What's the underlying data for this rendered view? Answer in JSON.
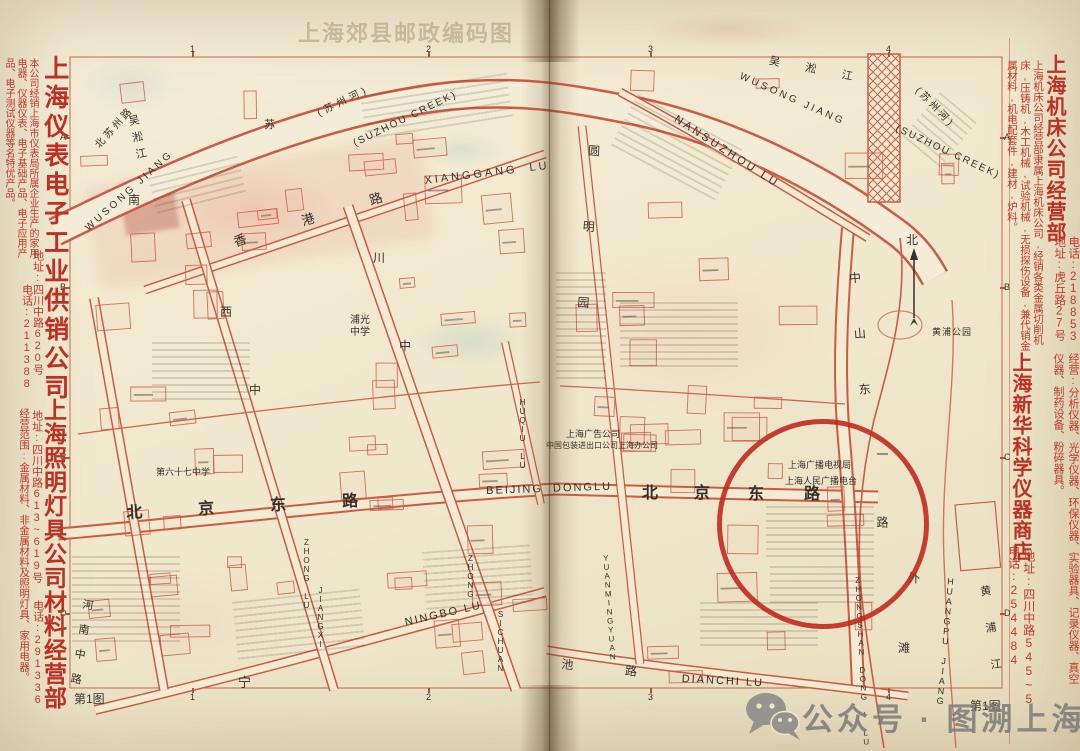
{
  "page": {
    "bleed_title": "上海郊县邮政编码图",
    "sheet_label": "第1图",
    "watermark_text": "公众号 · 图溯上海",
    "watermark_icon": "wechat-icon"
  },
  "colors": {
    "paper": "#f1e9d0",
    "map_red": "#cd5a44",
    "ad_red": "#c0392b",
    "ink": "#35302a",
    "circle_red": "#c0251a",
    "watermark_gray": "#7a7a7a"
  },
  "ads": {
    "left_top": {
      "title": "上海仪表电子工业供销公司",
      "body": "本公司经销上海市仪表局所属企业生产的家用电器、仪器仪表、电子基础产品、电子应用产品、电子测试仪器等名特优产品。",
      "address": "地址:四川中路620号",
      "phone": "电话:211388"
    },
    "left_bottom": {
      "title": "上海照明灯具公司材料经营部",
      "body": "经营范围:金属材料、非金属材料及照明灯具、家用电器。",
      "address": "地址:四川中路613~619号",
      "phone": "电话:291336"
    },
    "right_top": {
      "title": "上海机床公司经营部",
      "body": "上海机床公司经营部隶属上海机床公司,经销各类金属切削机床,压铸机,木工机械,试验机械,无损探伤设备,兼代销金属材料,机电配套件,建材,炉料。",
      "address": "地址:虎丘路27号",
      "phone": "电话:218853"
    },
    "right_bottom": {
      "title": "上海新华科学仪器商店",
      "body": "经营:分析仪器、光学仪器、环保仪器、实验器具、记录仪器、真空仪器、制药设备、粉碎器具。",
      "address": "地址:四川中路545~5",
      "phone": "电话:254484"
    }
  },
  "grid": {
    "columns": [
      "1",
      "2",
      "3",
      "4"
    ],
    "rows": [
      "A",
      "B",
      "C",
      "D"
    ]
  },
  "map_labels": [
    {
      "t": "WUSONG JIANG",
      "x": 84,
      "y": 226,
      "fs": 10,
      "ls": 3,
      "rot": -42
    },
    {
      "t": "(苏州河)",
      "x": 316,
      "y": 110,
      "fs": 10,
      "ls": 4,
      "rot": -26
    },
    {
      "t": "(SUZHOU CREEK)",
      "x": 352,
      "y": 140,
      "fs": 10,
      "ls": 2,
      "rot": -26
    },
    {
      "t": "北苏州路",
      "x": 94,
      "y": 144,
      "fs": 10,
      "ls": 3,
      "rot": -48
    },
    {
      "t": "吴淞江",
      "x": 126,
      "y": 116,
      "fs": 11,
      "ls": 6,
      "v": 1,
      "rot": -12
    },
    {
      "t": "南",
      "x": 128,
      "y": 194,
      "fs": 12
    },
    {
      "t": "苏",
      "x": 264,
      "y": 120,
      "fs": 11
    },
    {
      "t": "吴淞江",
      "x": 770,
      "y": 56,
      "fs": 11,
      "ls": 26,
      "rot": 11
    },
    {
      "t": "WUSONG JIANG",
      "x": 742,
      "y": 72,
      "fs": 10,
      "ls": 3,
      "rot": 24
    },
    {
      "t": "(苏州河)",
      "x": 920,
      "y": 86,
      "fs": 10,
      "ls": 3,
      "rot": 46
    },
    {
      "t": "(SUZHOU CREEK)",
      "x": 898,
      "y": 124,
      "fs": 10,
      "ls": 2,
      "rot": 25
    },
    {
      "t": "NANSUZHOU LU",
      "x": 678,
      "y": 114,
      "fs": 11,
      "ls": 3,
      "rot": 33
    },
    {
      "t": "XIANGGANG  LU",
      "x": 424,
      "y": 176,
      "fs": 11,
      "ls": 3,
      "rot": -7
    },
    {
      "t": "香港路",
      "x": 232,
      "y": 236,
      "fs": 13,
      "ls": 58,
      "rot": -17
    },
    {
      "t": "北京东路",
      "x": 126,
      "y": 506,
      "fs": 16,
      "ls": 56,
      "rot": -3,
      "w": 700
    },
    {
      "t": "BEIJING  DONGLU",
      "x": 486,
      "y": 486,
      "fs": 11,
      "ls": 2,
      "rot": -2
    },
    {
      "t": "北京",
      "x": 642,
      "y": 486,
      "fs": 16,
      "ls": 36,
      "w": 700
    },
    {
      "t": "东路",
      "x": 748,
      "y": 487,
      "fs": 16,
      "ls": 40,
      "w": 700
    },
    {
      "t": "NINGBO LU",
      "x": 404,
      "y": 618,
      "fs": 11,
      "ls": 2,
      "rot": -13
    },
    {
      "t": "宁",
      "x": 238,
      "y": 676,
      "fs": 13
    },
    {
      "t": "河南中路",
      "x": 82,
      "y": 598,
      "fs": 11,
      "ls": 14,
      "v": 1,
      "rot": 9
    },
    {
      "t": "西",
      "x": 220,
      "y": 306,
      "fs": 12
    },
    {
      "t": "中",
      "x": 249,
      "y": 384,
      "fs": 12
    },
    {
      "t": "ZHONG LU",
      "x": 302,
      "y": 538,
      "fs": 8,
      "v": 1
    },
    {
      "t": "JIANGXI",
      "x": 316,
      "y": 586,
      "fs": 8,
      "v": 1
    },
    {
      "t": "川",
      "x": 373,
      "y": 252,
      "fs": 12
    },
    {
      "t": "中",
      "x": 399,
      "y": 340,
      "fs": 12
    },
    {
      "t": "ZHONG",
      "x": 466,
      "y": 554,
      "fs": 8,
      "v": 1
    },
    {
      "t": "SICHUAN",
      "x": 496,
      "y": 610,
      "fs": 8,
      "v": 1
    },
    {
      "t": "HUQIU LU",
      "x": 518,
      "y": 398,
      "fs": 8,
      "v": 1
    },
    {
      "t": "圆明园",
      "x": 588,
      "y": 144,
      "fs": 12,
      "ls": 64,
      "v": 1,
      "rot": 4
    },
    {
      "t": "YUANMINGYUAN",
      "x": 601,
      "y": 554,
      "fs": 8,
      "v": 1,
      "rot": -4
    },
    {
      "t": "池路",
      "x": 562,
      "y": 658,
      "fs": 12,
      "ls": 52,
      "rot": 6
    },
    {
      "t": "DIANCHI LU",
      "x": 682,
      "y": 674,
      "fs": 11,
      "ls": 2,
      "rot": 3
    },
    {
      "t": "中山东",
      "x": 848,
      "y": 272,
      "fs": 12,
      "ls": 44,
      "v": 1,
      "rot": -5
    },
    {
      "t": "一路",
      "x": 876,
      "y": 448,
      "fs": 12,
      "ls": 56,
      "v": 1
    },
    {
      "t": "ZHONGSHAN DONG I LU",
      "x": 853,
      "y": 576,
      "fs": 8,
      "v": 1,
      "rot": -3
    },
    {
      "t": "外",
      "x": 908,
      "y": 572,
      "fs": 12
    },
    {
      "t": "滩",
      "x": 898,
      "y": 642,
      "fs": 12
    },
    {
      "t": "HUANGPU JIANG",
      "x": 946,
      "y": 576,
      "fs": 9,
      "v": 1,
      "rot": 5
    },
    {
      "t": "黄浦江",
      "x": 978,
      "y": 586,
      "fs": 11,
      "ls": 26,
      "v": 1,
      "rot": -8
    },
    {
      "t": "黄浦公园",
      "x": 932,
      "y": 328,
      "fs": 9,
      "ls": 1
    },
    {
      "t": "北",
      "x": 906,
      "y": 234,
      "fs": 12
    },
    {
      "t": "浦光",
      "x": 350,
      "y": 316,
      "fs": 10
    },
    {
      "t": "中学",
      "x": 350,
      "y": 328,
      "fs": 10
    },
    {
      "t": "第六十七中学",
      "x": 156,
      "y": 468,
      "fs": 9
    },
    {
      "t": "上海广告公司",
      "x": 566,
      "y": 430,
      "fs": 9
    },
    {
      "t": "中国包装进出口公司上海办公司",
      "x": 546,
      "y": 442,
      "fs": 8
    },
    {
      "t": "上海广播电视局",
      "x": 788,
      "y": 461,
      "fs": 9
    },
    {
      "t": "上海人民广播电台",
      "x": 785,
      "y": 477,
      "fs": 9
    }
  ]
}
